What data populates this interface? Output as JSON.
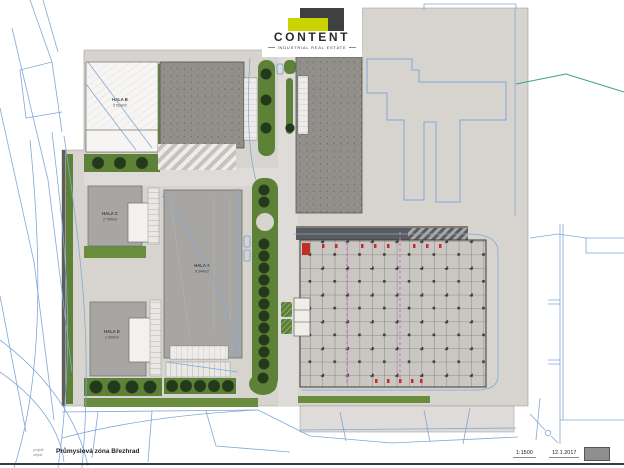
{
  "logo": {
    "brand": "CONTENT",
    "tagline": "INDUSTRIAL REAL ESTATE"
  },
  "buildings": {
    "hala_a": {
      "label": "HALA A",
      "area": "8 544m2"
    },
    "hala_b": {
      "label": "HALA B",
      "area": "3 599m2"
    },
    "hala_c": {
      "label": "HALA C",
      "area": "2 799m2"
    },
    "hala_d": {
      "label": "HALA D",
      "area": "2 399m2"
    }
  },
  "titleblock": {
    "row1_label": "projekt",
    "row2_label": "objekt",
    "title": "Průmyslová zóna Březhrad",
    "scale": "1:1500",
    "date": "12.1.2017"
  },
  "colors": {
    "logo_lime": "#c9d400",
    "logo_dark": "#3f4040",
    "cadastral_blue": "#7fa9d6",
    "utility_teal": "#3f9e96",
    "landscape_green": "#5d8136",
    "tree_green": "#24391b",
    "paving_gray": "#d7d4d0",
    "warehouse_dark": "#8f8e88",
    "hall_gray": "#a7a6a2",
    "grid_line": "#55554f",
    "axis_magenta": "#cf6fcf",
    "marker_red": "#c03028"
  }
}
